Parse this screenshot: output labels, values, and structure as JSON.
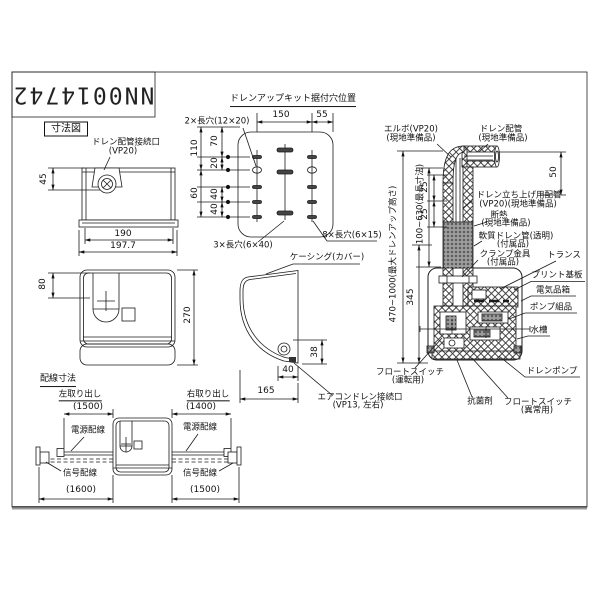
{
  "doc": {
    "number": "NN0014742"
  },
  "sections": {
    "dimension_title": "寸法図",
    "hole_title": "ドレンアップキット据付穴位置",
    "wiring_title": "配線寸法",
    "left_takeout": "左取り出し",
    "right_takeout": "右取り出し"
  },
  "front_view": {
    "port_line1": "ドレン配管接続口",
    "port_line2": "(VP20)",
    "dim_45": "45",
    "dim_190": "190",
    "dim_197_7": "197.7"
  },
  "top_view": {
    "dim_80": "80",
    "dim_270": "270"
  },
  "hole_view": {
    "dim_150": "150",
    "dim_55": "55",
    "slot_2x": "2×長穴(12×20)",
    "slot_3x": "3×長穴(6×40)",
    "slot_8x": "8×長穴(6×15)",
    "dim_110": "110",
    "dim_70": "70",
    "dim_20": "20",
    "dim_60": "60",
    "dim_40a": "40",
    "dim_40b": "40"
  },
  "side_view": {
    "casing_label": "ケーシング(カバー)",
    "dim_38": "38",
    "dim_40": "40",
    "dim_165": "165",
    "aircon_line1": "エアコンドレン接続口",
    "aircon_line2": "(VP13, 左右)"
  },
  "piping_view": {
    "elbow_line1": "エルボ(VP20)",
    "elbow_line2": "(現地準備品)",
    "drainpipe_line1": "ドレン配管",
    "drainpipe_line2": "(現地準備品)",
    "dim_50": "50",
    "dim_25a": "25",
    "dim_25b": "25",
    "dim_riser_range": "100~630(最長寸法)",
    "dim_lift_range": "470~1000(最大ドレンアップ高さ)",
    "dim_345": "345",
    "riser_line1": "ドレン立ち上げ用配管",
    "riser_line2": "(VP20)(現地準備品)",
    "insul_line1": "断熱",
    "insul_line2": "(現地準備品)",
    "soft_line1": "軟質ドレン管(透明)",
    "soft_line2": "(付属品)",
    "clamp_line1": "クランプ金具",
    "clamp_line2": "(付属品)",
    "transformer": "トランス",
    "pcb": "プリント基板",
    "elec_box": "電気品箱",
    "pump_assy": "ポンプ組品",
    "tank": "水槽",
    "drain_pump": "ドレンポンプ",
    "float_run_line1": "フロートスイッチ",
    "float_run_line2": "(運転用)",
    "antibacterial": "抗菌剤",
    "float_abn_line1": "フロートスイッチ",
    "float_abn_line2": "(異常用)"
  },
  "wiring": {
    "dim_left_power": "(1500)",
    "dim_right_power": "(1400)",
    "dim_left_signal": "(1600)",
    "dim_right_signal": "(1500)",
    "power_left": "電源配線",
    "power_right": "電源配線",
    "signal_left": "信号配線",
    "signal_right": "信号配線"
  },
  "colors": {
    "line": "#1a1a1a",
    "background": "#ffffff"
  }
}
